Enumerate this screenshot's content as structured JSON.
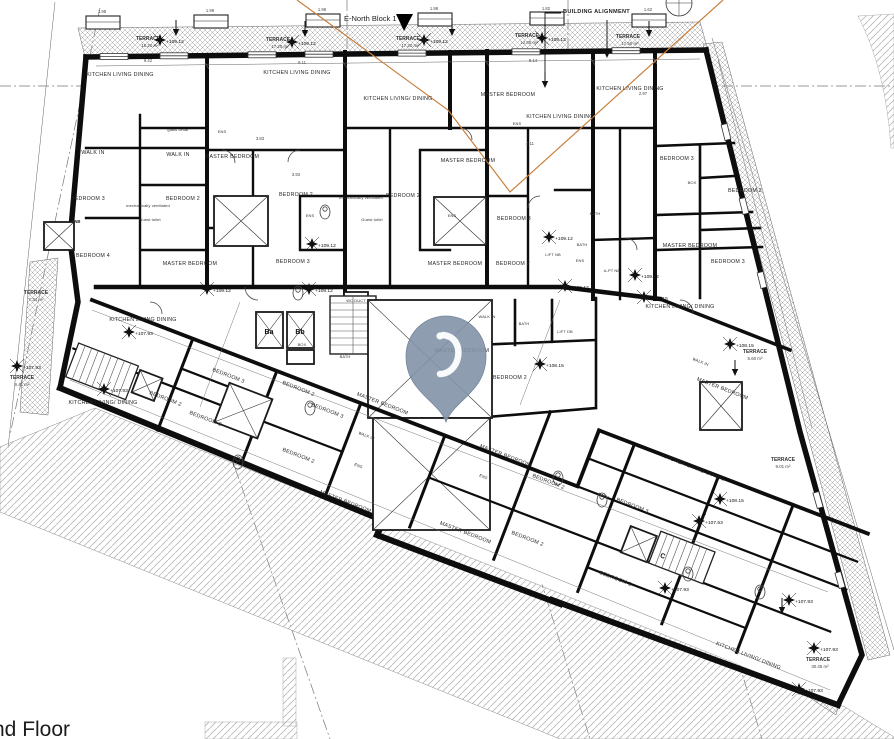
{
  "title": {
    "floor_label": "nd Floor"
  },
  "header": {
    "block_label": "E-North Block 1",
    "alignment_label": "BUILDING ALIGNMENT"
  },
  "colors": {
    "wall": "#0d0d0d",
    "alignment_line": "#c8813f",
    "pin_fill": "#8294a7",
    "hatch": "#999999"
  },
  "pin": {
    "kind": "map-location-pin"
  },
  "rooms": [
    "KITCHEN LIVING DINING",
    "KITCHEN LIVING DINING",
    "KITCHEN LIVING/ DINING",
    "MASTER BEDROOM",
    "KITCHEN LIVING DINING",
    "KITCHEN LIVING DINING",
    "glass cellar",
    "WALK IN",
    "WALK IN",
    "MASTER BEDROOM",
    "MASTER BEDROOM",
    "BEDROOM 3",
    "BEDROOM 3",
    "BEDROOM 2",
    "BEDROOM 2",
    "BEDROOM 2",
    "BEDROOM 3",
    "BEDROOM 2",
    "MASTER BEDROOM",
    "BEDROOM 4",
    "MASTER BEDROOM",
    "BEDROOM 3",
    "MASTER BEDROOM",
    "BEDROOM 2",
    "BEDROOM 3",
    "ENS",
    "ENS",
    "ENS",
    "ENS",
    "ENS",
    "BATH",
    "BATH",
    "BOX",
    "BOX",
    "BATH",
    "WALK IN",
    "BATH",
    "BEDROOM 2",
    "MASTER BEDROOM",
    "KITCHEN LIVING DINING",
    "KITCHEN LIVING/ DINING",
    "BEDROOM 3",
    "BEDROOM 3",
    "BEDROOM 2",
    "BEDROOM 2",
    "BEDROOM 3",
    "MASTER BEDROOM",
    "WALK IN",
    "BEDROOM 2",
    "ENS",
    "MASTER BEDROOM",
    "MASTER BEDROOM",
    "BEDROOM 2",
    "BATH",
    "BEDROOM 3",
    "BEDROOM 2",
    "BEDROOM 3",
    "KITCHEN LIVING DINING",
    "MASTER BEDROOM",
    "ENS",
    "KITCHEN LIVING/ DINING",
    "WALK IN",
    "MASTER BEDROOM",
    "KITCHEN LIVING/ DINING",
    "mechanically ventilated",
    "mechanically ventilated",
    "Guest toilet",
    "Guest toilet",
    "LIFT NB",
    "A-PT NB",
    "LIFT DB",
    "ENB",
    "WC DUCT",
    "Ba",
    "Bb",
    "C"
  ],
  "marks": [
    "+109.12",
    "+109.12",
    "+109.12",
    "+109.12",
    "+109.12",
    "+109.12",
    "+109.12",
    "+109.12",
    "+109.12",
    "+109.12",
    "+108.15",
    "+108.15",
    "+108.15",
    "+108.15",
    "+107.93",
    "+107.93",
    "+107.93",
    "+107.93",
    "+107.93",
    "+107.93",
    "+107.93",
    "+107.63"
  ],
  "terraces": [
    {
      "label": "TERRACE",
      "area": "15.20 m²"
    },
    {
      "label": "TERRACE",
      "area": "17.20 m²"
    },
    {
      "label": "TERRACE",
      "area": "17.20 m²"
    },
    {
      "label": "TERRACE",
      "area": "12.05 m²"
    },
    {
      "label": "TERRACE",
      "area": "17.50 m²"
    },
    {
      "label": "TERRACE",
      "area": "7.34 m²"
    },
    {
      "label": "TERRACE",
      "area": "9.41 m²"
    },
    {
      "label": "TERRACE",
      "area": "5.60 m²"
    },
    {
      "label": "TERRACE",
      "area": "9.01 m²"
    },
    {
      "label": "TERRACE",
      "area": "30.45 m²"
    }
  ],
  "dims": [
    "1.98",
    "1.99",
    "1.98",
    "1.98",
    "1.82",
    "1.62",
    "9.42",
    "9.11",
    "9.14",
    "3.93",
    "4.11",
    "2.97",
    "3.83"
  ]
}
